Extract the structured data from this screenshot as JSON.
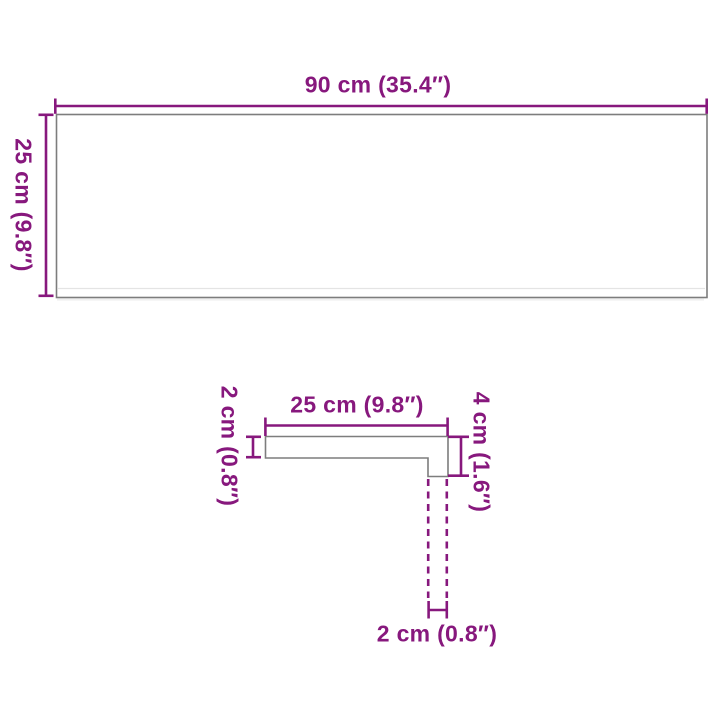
{
  "diagram_title": "Stair tread dimension diagram",
  "colors": {
    "dimension_accent": "#87187D",
    "shape_outline": "#7D7D7D",
    "background": "#FFFFFF"
  },
  "top_view": {
    "width_label": "90 cm (35.4″)",
    "height_label": "25 cm (9.8″)"
  },
  "profile_view": {
    "depth_label": "25 cm (9.8″)",
    "thickness_label": "2 cm (0.8″)",
    "nosing_height_label": "4 cm (1.6″)",
    "nosing_width_label": "2 cm (0.8″)"
  }
}
